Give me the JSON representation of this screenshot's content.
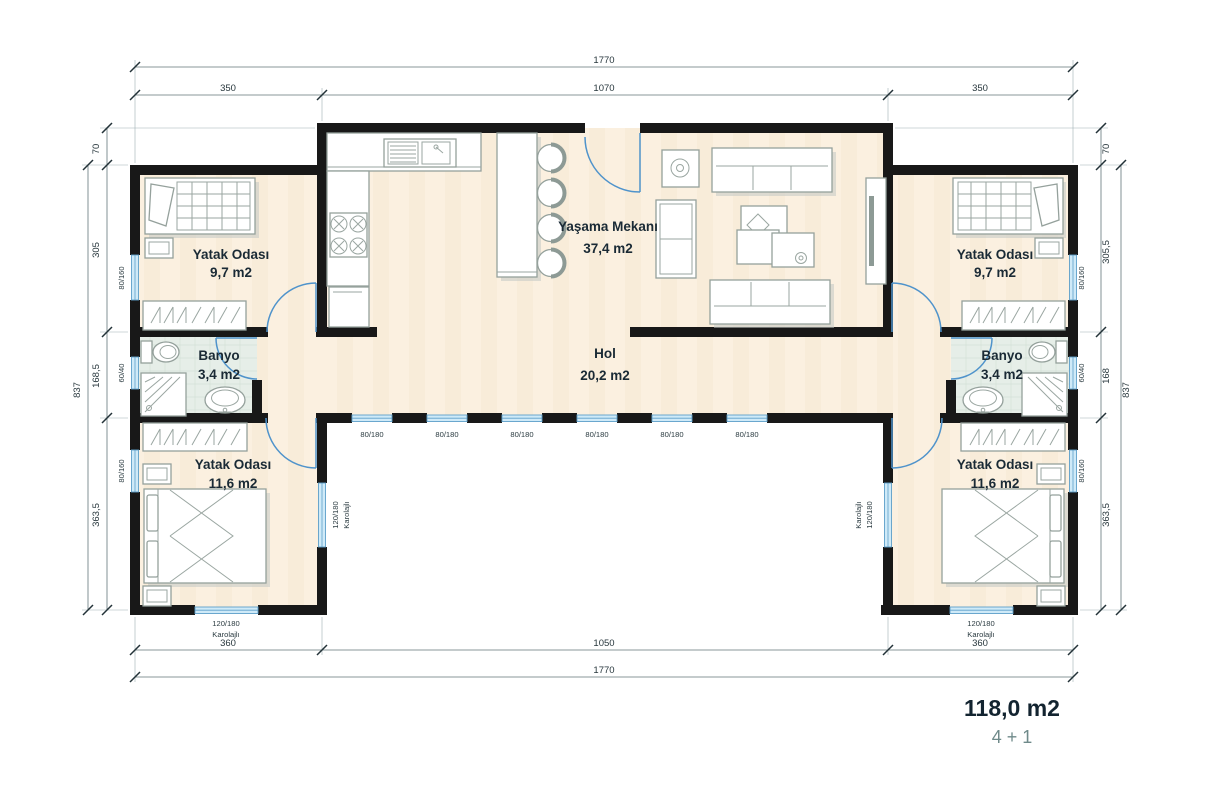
{
  "plan": {
    "summary": {
      "area": "118,0 m2",
      "layout": "4 + 1"
    },
    "rooms": {
      "bedroom_tl": {
        "name": "Yatak Odası",
        "area": "9,7 m2"
      },
      "bedroom_tr": {
        "name": "Yatak Odası",
        "area": "9,7 m2"
      },
      "bedroom_bl": {
        "name": "Yatak Odası",
        "area": "11,6 m2"
      },
      "bedroom_br": {
        "name": "Yatak Odası",
        "area": "11,6 m2"
      },
      "bath_l": {
        "name": "Banyo",
        "area": "3,4 m2"
      },
      "bath_r": {
        "name": "Banyo",
        "area": "3,4 m2"
      },
      "living": {
        "name": "Yaşama Mekanı",
        "area": "37,4 m2"
      },
      "hall": {
        "name": "Hol",
        "area": "20,2 m2"
      }
    },
    "dims": {
      "top_total": "1770",
      "top_segments": [
        "350",
        "1070",
        "350"
      ],
      "bottom_segments": [
        "360",
        "1050",
        "360"
      ],
      "bottom_total": "1770",
      "left_top_offset": "70",
      "left_segments": [
        "305",
        "168,5",
        "363,5"
      ],
      "left_total": "837",
      "right_top_offset": "70",
      "right_segments": [
        "305,5",
        "168",
        "363,5"
      ],
      "right_total": "837"
    },
    "windows": {
      "hall_labels": [
        "80/180",
        "80/180",
        "80/180",
        "80/180",
        "80/180",
        "80/180"
      ],
      "left_wall": [
        "80/160",
        "60/40",
        "80/160"
      ],
      "right_wall": [
        "80/160",
        "60/40",
        "80/160"
      ],
      "bottom_left": {
        "size": "120/180",
        "type": "Karolajlı"
      },
      "bottom_right": {
        "size": "120/180",
        "type": "Karolajlı"
      },
      "inner_left": {
        "size": "120/180",
        "type": "Karolajlı"
      },
      "inner_right": {
        "size": "120/180",
        "type": "Karolajlı"
      }
    },
    "colors": {
      "wall": "#181818",
      "floor": "#fbf0e0",
      "bath_floor": "#e6eee8",
      "window": "#cfeaf8",
      "door": "#4f93cb",
      "dim_text": "#27363c",
      "room_text": "#1a2a35",
      "subtitle": "#6f8a8a"
    }
  }
}
